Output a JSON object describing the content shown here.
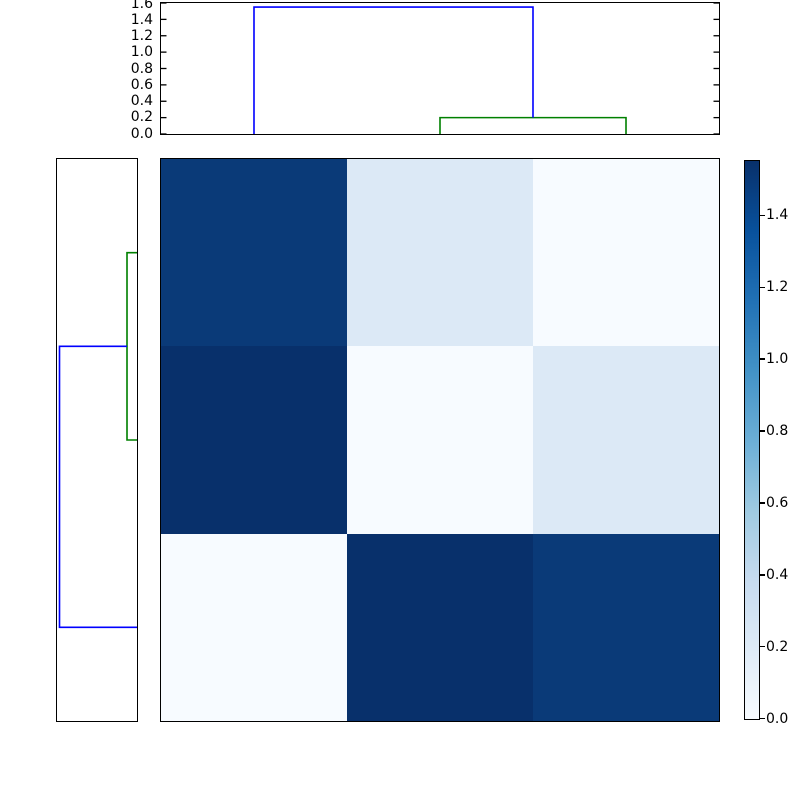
{
  "figure": {
    "kind": "hierarchical-clustering-heatmap",
    "background": "#ffffff"
  },
  "colors": {
    "link_blue": "#0000ff",
    "link_green": "#008000",
    "axis": "#000000",
    "text": "#000000"
  },
  "chart_data": {
    "type": "heatmap",
    "title": "",
    "xlabel": "",
    "ylabel": "",
    "colormap": "Blues",
    "vmin": 0.0,
    "vmax": 1.55,
    "grid": false,
    "matrix_rows_top_to_bottom": [
      [
        1.5,
        0.2,
        0.0
      ],
      [
        1.55,
        0.0,
        0.2
      ],
      [
        0.0,
        1.55,
        1.5
      ]
    ],
    "cell_colors": [
      [
        "#0a3a78",
        "#dce9f6",
        "#f7fbff"
      ],
      [
        "#08306b",
        "#f7fbff",
        "#dce9f6"
      ],
      [
        "#f7fbff",
        "#08306b",
        "#0a3a78"
      ]
    ],
    "pairwise_distances": {
      "d_1_2": 1.55,
      "d_1_3": 1.5,
      "d_2_3": 0.2
    },
    "top_dendrogram": {
      "orientation": "top",
      "n_leaves": 3,
      "axis_max": 1.6,
      "axis_tick_labels": [
        "1.6",
        "1.4",
        "1.2",
        "1.0",
        "0.8",
        "0.6",
        "0.4",
        "0.2",
        "0.0"
      ],
      "merge_heights": [
        0.2,
        1.55
      ],
      "links": [
        {
          "id": "green",
          "color": "#008000",
          "points": [
            [
              1.5,
              0
            ],
            [
              1.5,
              0.2
            ],
            [
              2.5,
              0.2
            ],
            [
              2.5,
              0
            ]
          ]
        },
        {
          "id": "blue",
          "color": "#0000ff",
          "points": [
            [
              0.5,
              0
            ],
            [
              0.5,
              1.55
            ],
            [
              2.0,
              1.55
            ],
            [
              2.0,
              0.2
            ]
          ]
        }
      ]
    },
    "left_dendrogram": {
      "orientation": "left",
      "n_leaves": 3,
      "axis_max": 1.6,
      "axis_tick_labels": [],
      "merge_heights": [
        0.2,
        1.55
      ],
      "links": [
        {
          "id": "green",
          "color": "#008000",
          "points": [
            [
              0.5,
              0
            ],
            [
              0.5,
              0.2
            ],
            [
              1.5,
              0.2
            ],
            [
              1.5,
              0
            ]
          ]
        },
        {
          "id": "blue",
          "color": "#0000ff",
          "points": [
            [
              1.0,
              0.2
            ],
            [
              1.0,
              1.55
            ],
            [
              2.5,
              1.55
            ],
            [
              2.5,
              0
            ]
          ]
        }
      ]
    },
    "colorbar": {
      "position": "right",
      "tick_labels": [
        "1.4",
        "1.2",
        "1.0",
        "0.8",
        "0.6",
        "0.4",
        "0.2",
        "0.0"
      ],
      "gradient_stops": [
        {
          "pos": 0.0,
          "color": "#f7fbff"
        },
        {
          "pos": 0.125,
          "color": "#deebf7"
        },
        {
          "pos": 0.25,
          "color": "#c6dbef"
        },
        {
          "pos": 0.375,
          "color": "#9ecae1"
        },
        {
          "pos": 0.5,
          "color": "#6baed6"
        },
        {
          "pos": 0.625,
          "color": "#4292c6"
        },
        {
          "pos": 0.75,
          "color": "#2171b5"
        },
        {
          "pos": 0.875,
          "color": "#08519c"
        },
        {
          "pos": 1.0,
          "color": "#08306b"
        }
      ]
    }
  }
}
